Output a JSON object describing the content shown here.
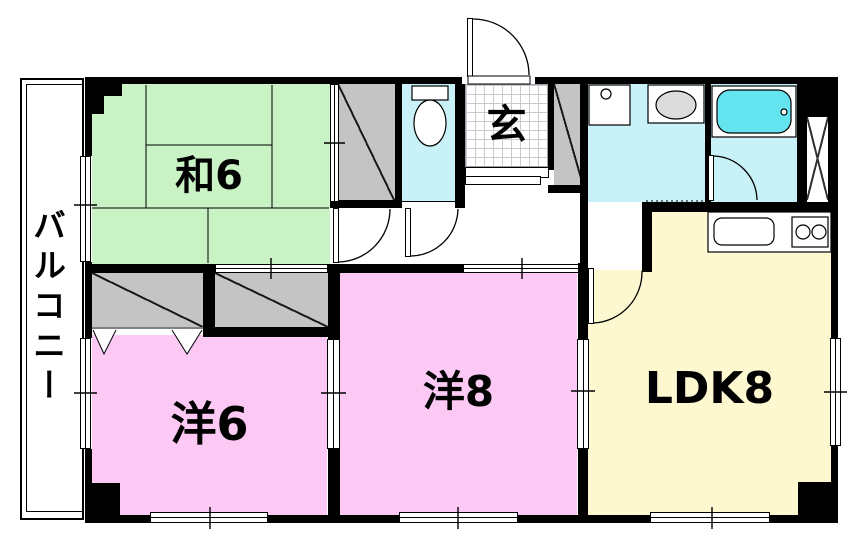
{
  "plan": {
    "rooms": {
      "washitsu": {
        "label": "和6"
      },
      "genkan": {
        "label": "玄"
      },
      "western6": {
        "label": "洋6"
      },
      "western8": {
        "label": "洋8"
      },
      "ldk": {
        "label": "LDK8"
      },
      "balcony": {
        "label": "バルコニー"
      }
    },
    "colors": {
      "tatami_green": "#c9f2c5",
      "western_pink": "#fbc9f3",
      "ldk_yellow": "#fdf8d0",
      "wet_area_cyan": "#c9f1f8",
      "tub_cyan": "#63e4ef",
      "closet_gray": "#c4c4c4",
      "wall_black": "#000000"
    }
  }
}
